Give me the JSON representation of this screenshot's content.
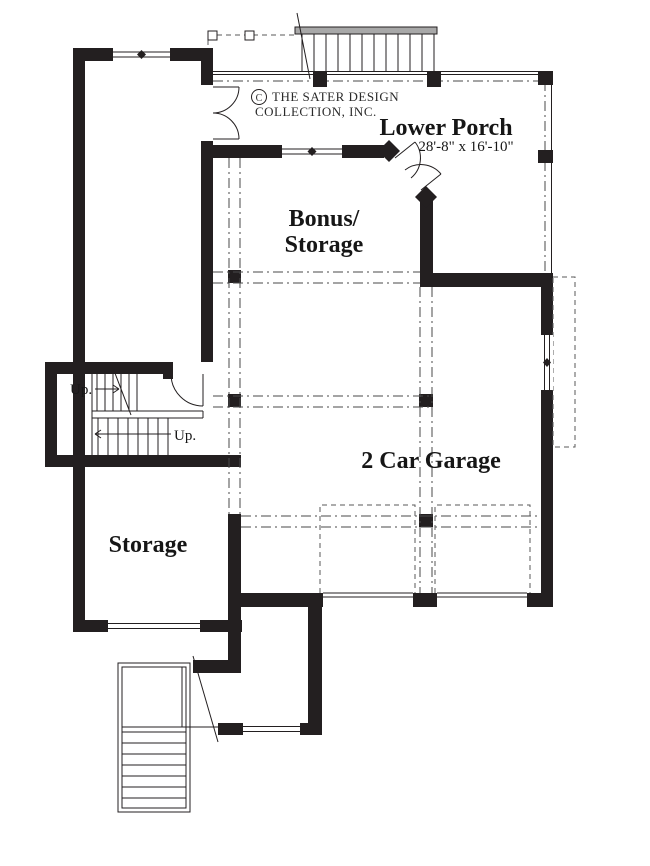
{
  "title_block": {
    "copyright_symbol": "C",
    "copyright_line1": "THE SATER DESIGN",
    "copyright_line2": "COLLECTION, INC."
  },
  "rooms": {
    "lower_porch": {
      "name": "Lower Porch",
      "dimensions": "28'-8\" x 16'-10\""
    },
    "bonus_storage": {
      "name_line1": "Bonus/",
      "name_line2": "Storage"
    },
    "garage": {
      "name": "2 Car Garage"
    },
    "storage": {
      "name": "Storage"
    }
  },
  "annotations": {
    "up_upper_flight": "Up.",
    "up_lower_flight": "Up."
  },
  "colors": {
    "wall": "#231f20",
    "centerline": "#4a4a4a",
    "stair_edge_bar": "#a8a8a8",
    "background": "#ffffff"
  }
}
